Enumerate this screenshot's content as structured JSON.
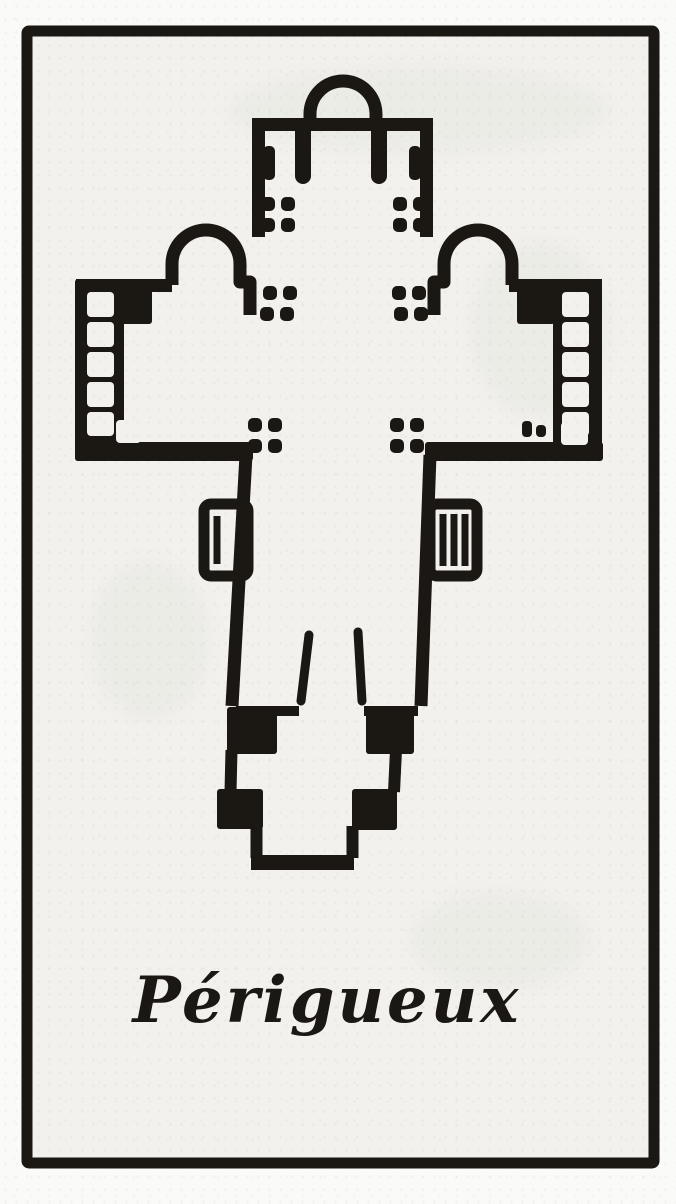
{
  "document": {
    "caption": "Périgueux"
  },
  "theme": {
    "ink": "#1b1712",
    "paper": "#f2f1ee",
    "margin": "#fafaf8",
    "bleed": "#e8e7e2"
  },
  "plan": {
    "features": [
      "apse-chapel-north",
      "chancel-arm",
      "transept-chapel-west",
      "transept-chapel-east",
      "west-arm-arcaded-wall",
      "east-arm-arcaded-wall",
      "crossing-pier-clusters",
      "nave-arm",
      "side-porch-west",
      "side-porch-east-stair",
      "western-narthex-bays"
    ]
  }
}
